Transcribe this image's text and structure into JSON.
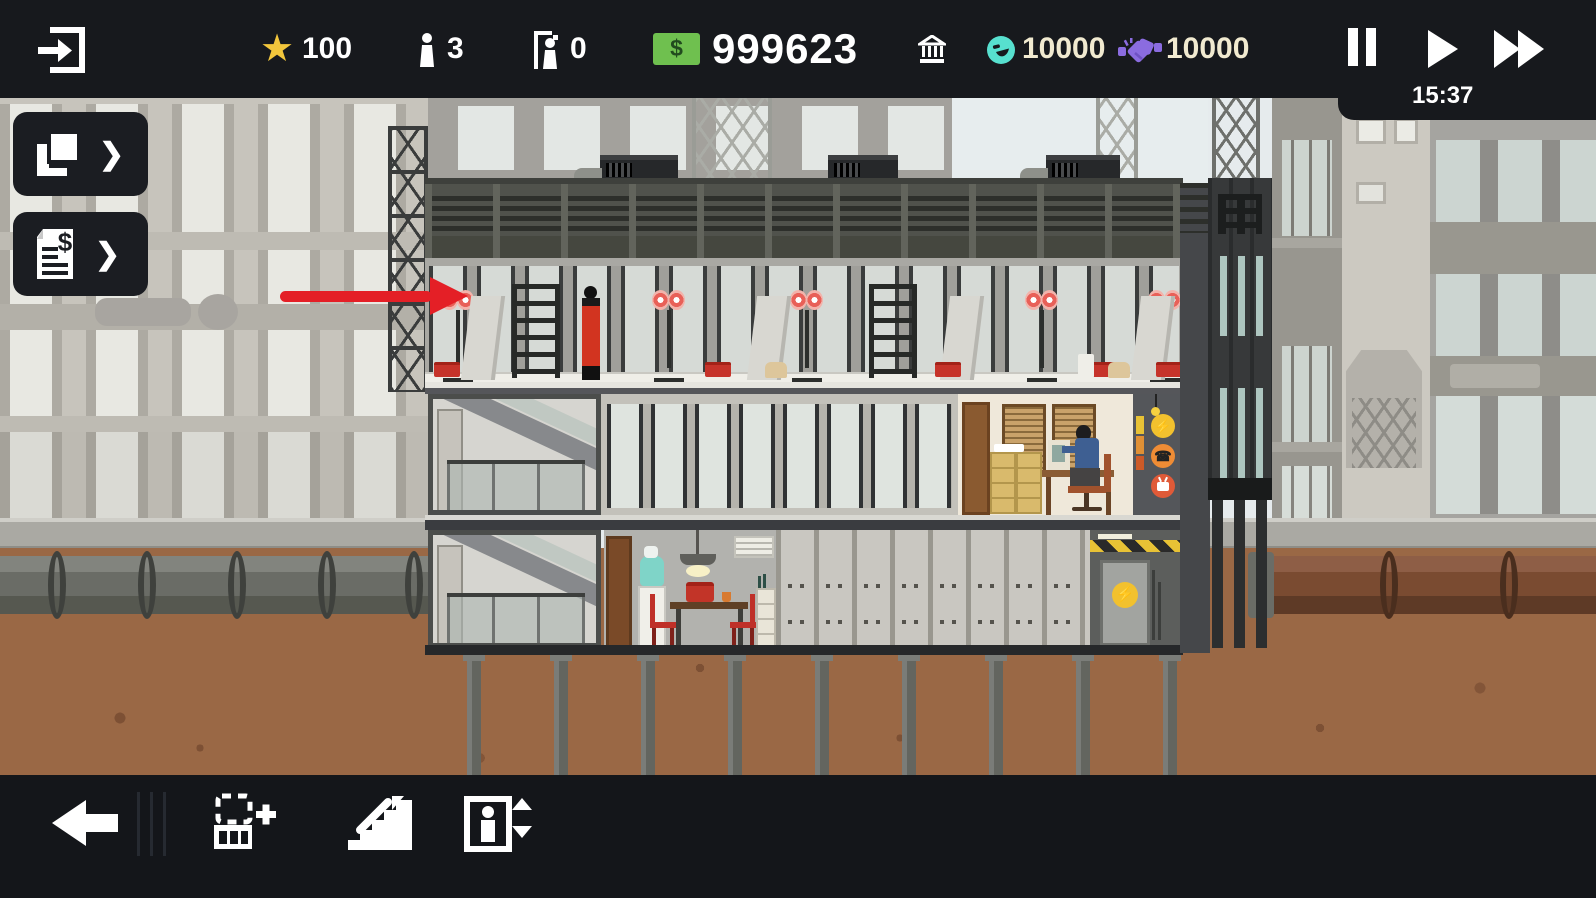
{
  "hud": {
    "star_count": "100",
    "population_count": "3",
    "visitor_count": "0",
    "money_symbol": "$",
    "money_amount": "999623",
    "influence_amount": "10000",
    "favor_amount": "10000",
    "clock_time": "15:37"
  },
  "side_panel": {
    "build_button_chevron": "❯",
    "finance_button_chevron": "❯"
  },
  "toolbar": {
    "items": [
      "back",
      "add-room",
      "add-stairs",
      "add-elevator"
    ]
  },
  "utilities": {
    "power_glyph": "⚡",
    "phone_glyph": "☎"
  },
  "colors": {
    "topbar_bg": "#17191d",
    "toolbar_bg": "#14161a",
    "money_green": "#6fc04f",
    "star_gold": "#f2c63c",
    "influence_teal": "#57e0cf",
    "favor_purple": "#8b6ce0",
    "resource_text_cream": "#f1ead0",
    "annotation_red": "#e41f26",
    "underground_brown": "#9a6845"
  },
  "scene": {
    "annotation_arrow_target": "construction-floor"
  }
}
